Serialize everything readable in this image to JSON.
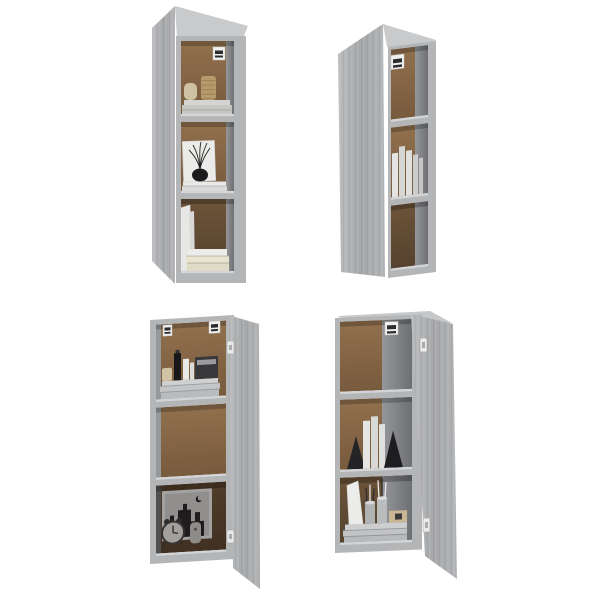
{
  "scene": {
    "type": "product-photo",
    "description": "Set of four gray Sonoma wall-mounted cabinets with open doors and three open compartments each, decorated with books, vases, a clock and accessories, on a plain white background",
    "layout": "2x2 grid of four tall narrow wall cabinets",
    "background_color": "#ffffff"
  },
  "palette": {
    "cabinet_gray": "#b4b5b7",
    "cabinet_gray_light": "#c9cacc",
    "cabinet_gray_dark": "#9a9b9d",
    "door_gray": "#a6a7a9",
    "back_panel_brown": "#8c6c4a",
    "back_panel_brown_dark": "#634c35",
    "interior_side_gray": "#77787a",
    "shelf_highlight": "#d4d5d7",
    "item_white": "#e9e9e7",
    "item_cream": "#e8e4cf",
    "item_black": "#1c1c1e",
    "item_beige": "#cec2a3",
    "item_tan": "#b59b6c",
    "hardware_white": "#f0f0ee"
  },
  "cabinets": [
    {
      "id": "cabinet-top-left",
      "grid_position": "top-left",
      "door_side": "left",
      "door_state": "open",
      "hardware": [
        "wall-mount keyhole bracket"
      ],
      "compartments": [
        {
          "position": "top",
          "items": [
            "beige ceramic vase",
            "ribbed tan vase",
            "stack of white magazines",
            "wall-mount bracket"
          ]
        },
        {
          "position": "middle",
          "items": [
            "white canvas with twig print",
            "black round vase with branches",
            "stack of white books"
          ]
        },
        {
          "position": "bottom",
          "items": [
            "two leaning white books",
            "stack of cream books"
          ]
        }
      ]
    },
    {
      "id": "cabinet-top-right",
      "grid_position": "top-right",
      "door_side": "left",
      "door_state": "open",
      "hardware": [
        "wall-mount keyhole bracket"
      ],
      "compartments": [
        {
          "position": "top",
          "items": [
            "wall-mount bracket"
          ]
        },
        {
          "position": "middle",
          "items": [
            "row of standing white books"
          ]
        },
        {
          "position": "bottom",
          "items": []
        }
      ]
    },
    {
      "id": "cabinet-bottom-left",
      "grid_position": "bottom-left",
      "door_side": "right",
      "door_state": "open",
      "hardware": [
        "wall-mount keyhole bracket left",
        "wall-mount keyhole bracket right",
        "door hinge upper",
        "door hinge lower"
      ],
      "compartments": [
        {
          "position": "top",
          "items": [
            "cream jar",
            "black bottle",
            "white cosmetic tubes",
            "dark box with gray label",
            "stack of magazines"
          ]
        },
        {
          "position": "middle",
          "items": []
        },
        {
          "position": "bottom",
          "items": [
            "framed skyline print with crescent moon",
            "white alarm clock",
            "small gray ornament"
          ]
        }
      ]
    },
    {
      "id": "cabinet-bottom-right",
      "grid_position": "bottom-right",
      "door_side": "right",
      "door_state": "open",
      "hardware": [
        "wall-mount keyhole bracket",
        "door hinge upper",
        "door hinge lower"
      ],
      "compartments": [
        {
          "position": "top",
          "items": []
        },
        {
          "position": "middle",
          "items": [
            "black triangular bookend left",
            "three white books",
            "black triangular bookend right"
          ]
        },
        {
          "position": "bottom",
          "items": [
            "leaning white panel",
            "two gray pen cups with brushes",
            "small wooden box",
            "stack of magazines"
          ]
        }
      ]
    }
  ]
}
